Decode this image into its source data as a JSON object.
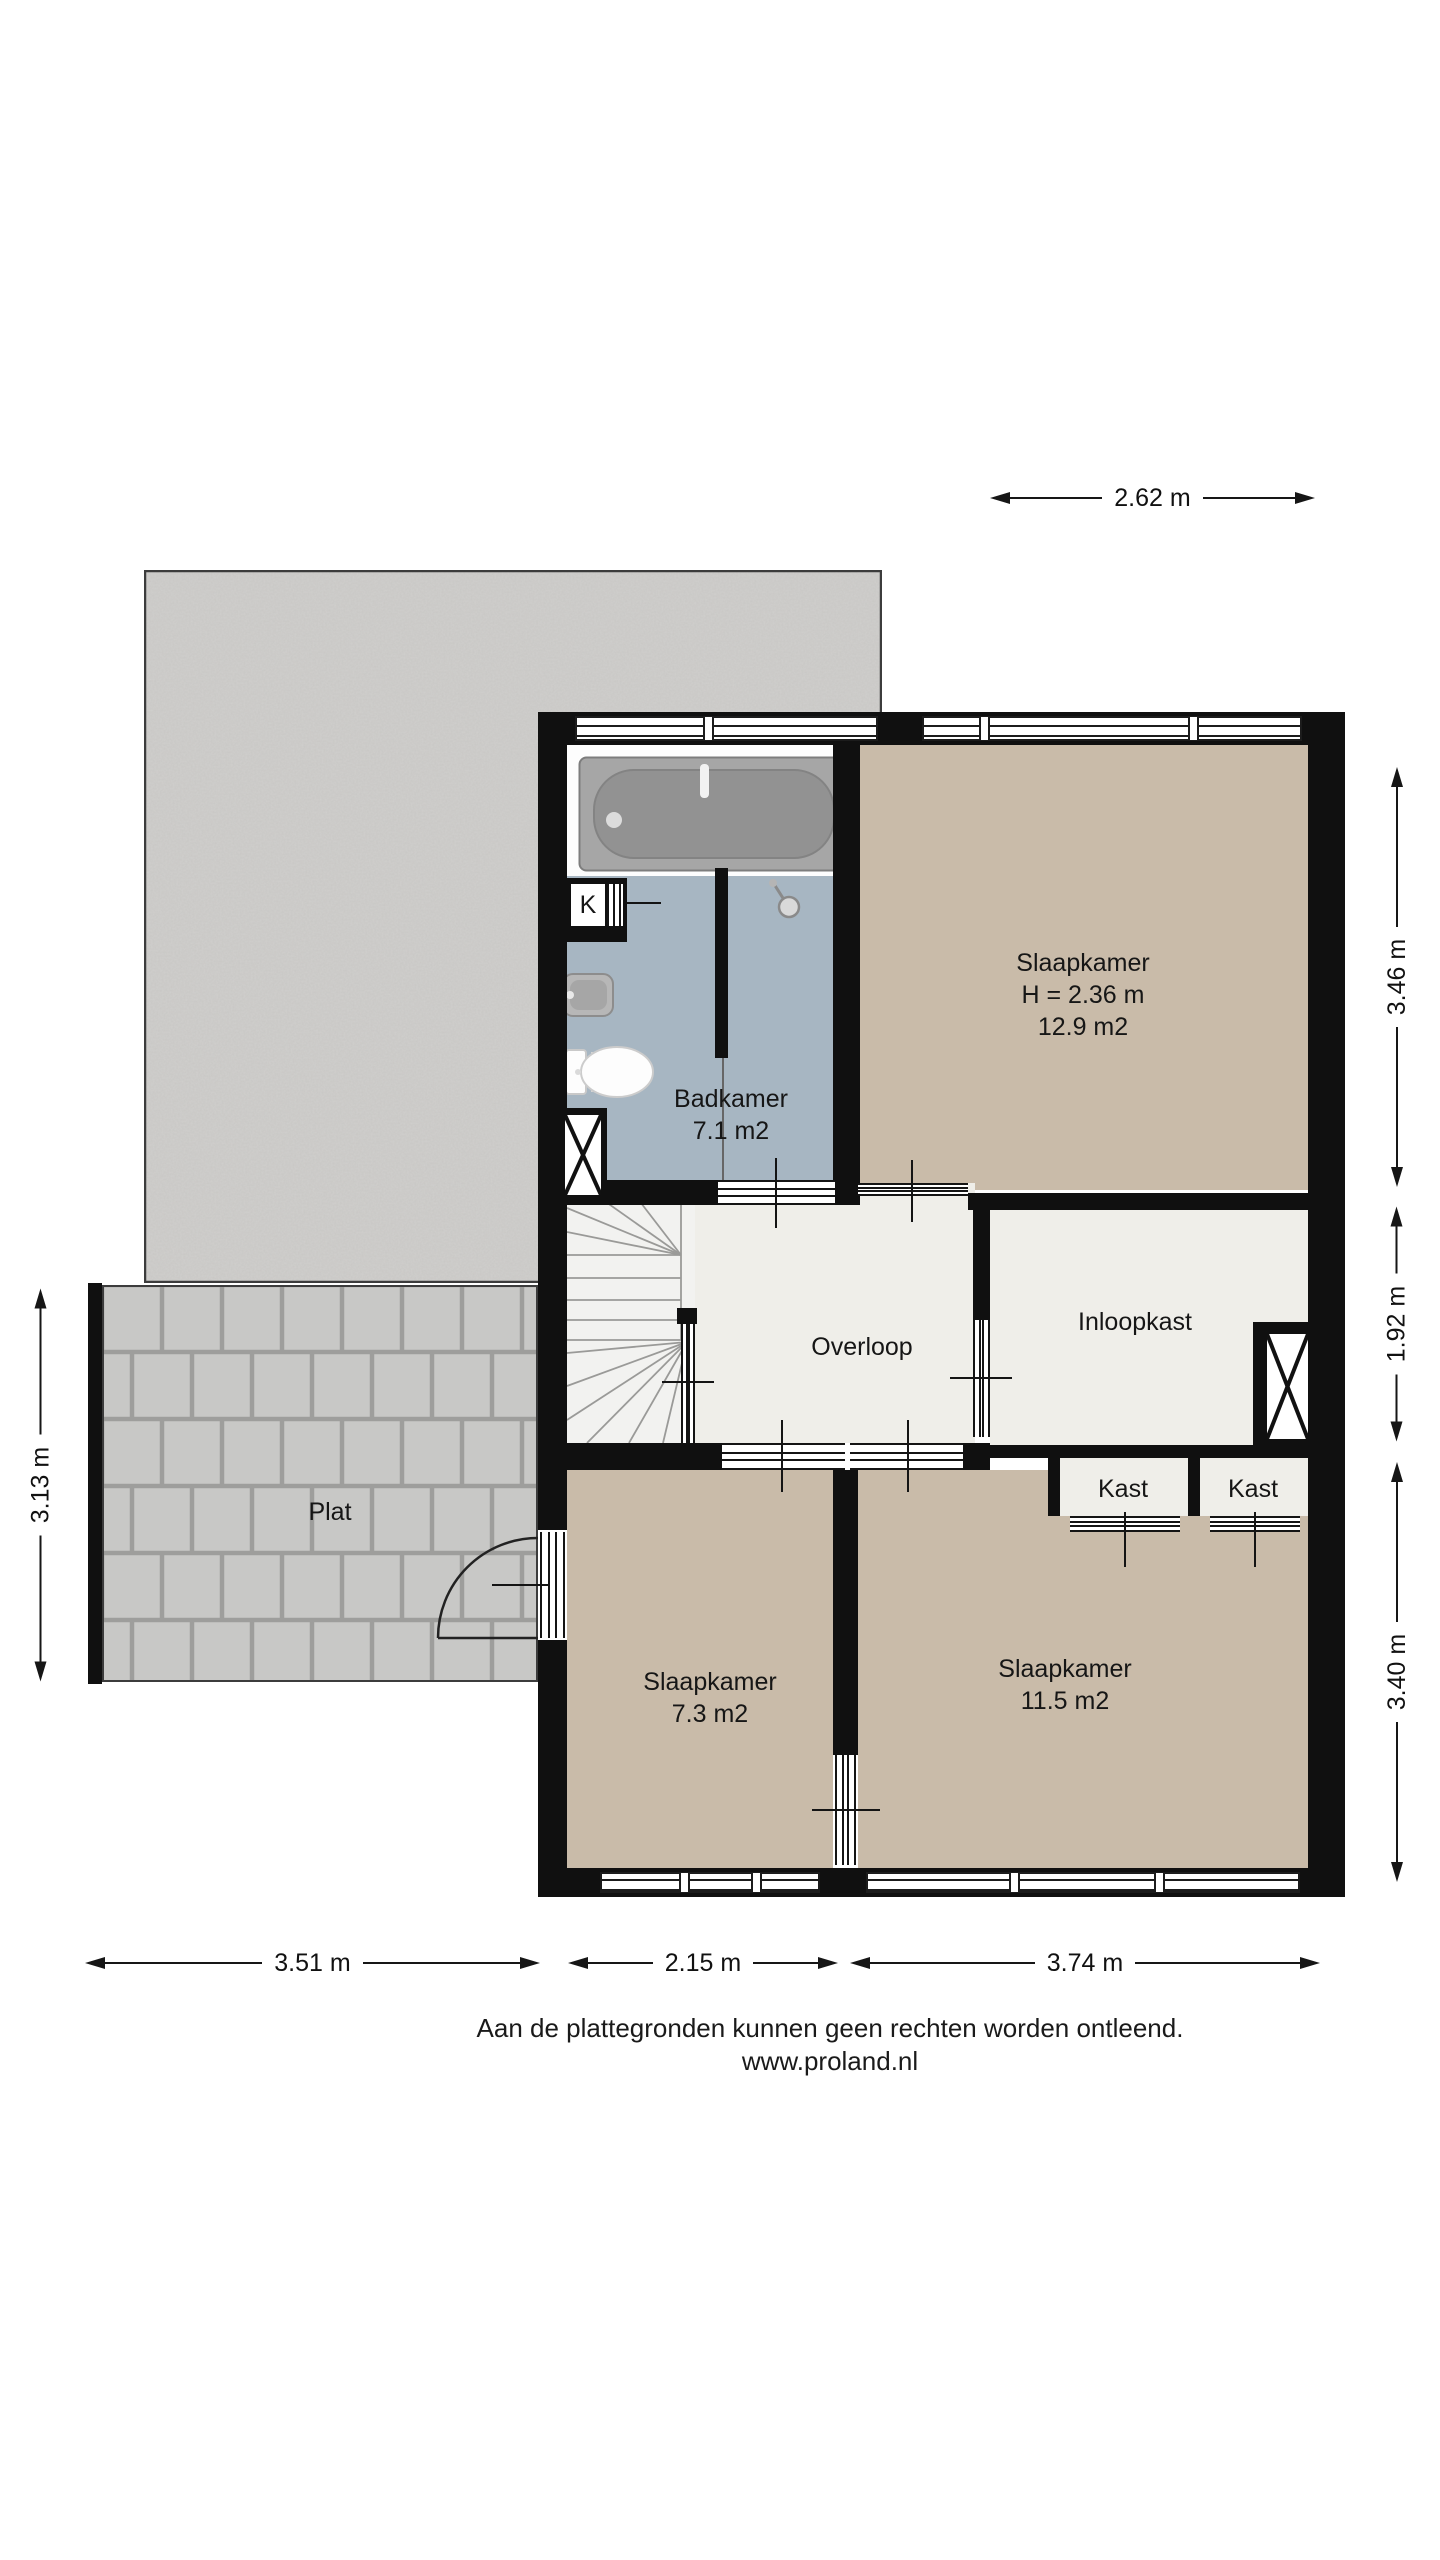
{
  "plan_title": "Verdieping plattegrond",
  "rooms": {
    "badkamer": {
      "name": "Badkamer",
      "area": "7.1 m2"
    },
    "slaapkamer_groot": {
      "name": "Slaapkamer",
      "ceiling": "H = 2.36 m",
      "area": "12.9 m2"
    },
    "overloop": {
      "name": "Overloop"
    },
    "inloopkast": {
      "name": "Inloopkast"
    },
    "kast_links": {
      "name": "Kast"
    },
    "kast_rechts": {
      "name": "Kast"
    },
    "slaapkamer_klein": {
      "name": "Slaapkamer",
      "area": "7.3 m2"
    },
    "slaapkamer_midden": {
      "name": "Slaapkamer",
      "area": "11.5 m2"
    },
    "plat": {
      "name": "Plat"
    },
    "schacht": {
      "label": "K"
    }
  },
  "dimensions": {
    "top": "2.62 m",
    "right_upper": "3.46 m",
    "right_middle": "1.92 m",
    "right_lower": "3.40 m",
    "left": "3.13 m",
    "bottom_left": "3.51 m",
    "bottom_middle": "2.15 m",
    "bottom_right": "3.74 m"
  },
  "footer": {
    "disclaimer": "Aan de plattegronden kunnen geen rechten worden ontleend.",
    "website": "www.proland.nl"
  },
  "colors": {
    "wall": "#101010",
    "bedroom_floor": "#c9bba9",
    "bathroom_floor": "#a7b6c2",
    "hall_floor": "#efeee9",
    "concrete": "#d0cfcd",
    "tiles": "#c8c8c6",
    "background": "#ffffff"
  }
}
